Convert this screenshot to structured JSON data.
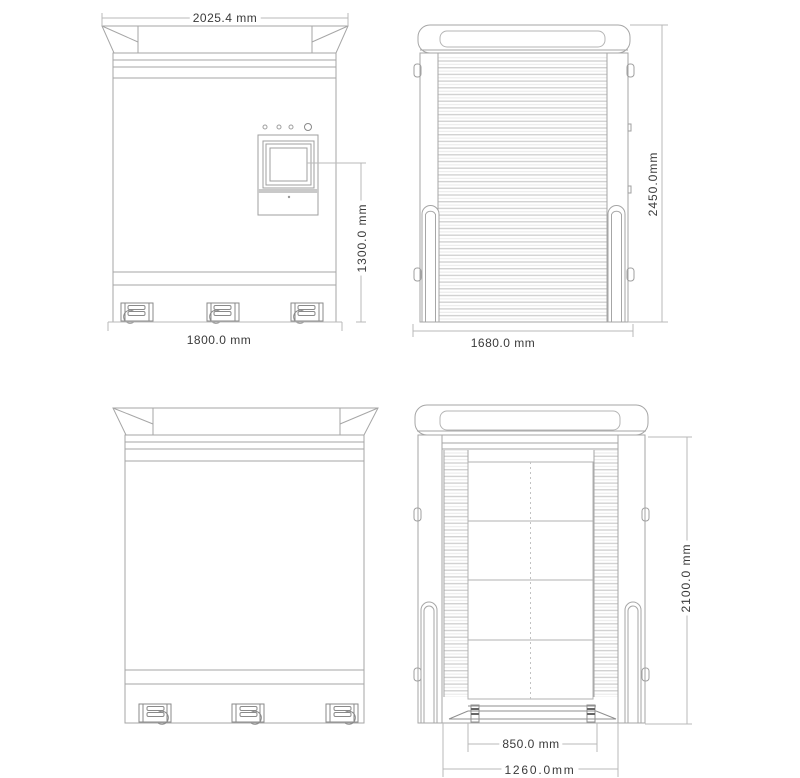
{
  "drawing": {
    "type": "four-view dimensional line drawing of an equipment cabinet",
    "colors": {
      "background": "#ffffff",
      "outline": "#a6a6a6",
      "dimension_lines": "#b9b9b9",
      "dimension_text": "#3a3a3a",
      "shutter_slat_dark": "#d2d2d2",
      "shutter_slat_light": "#e9e9e9"
    },
    "views": {
      "front": {
        "dim_top_width": "2025.4 mm",
        "dim_screen_height": "1300.0 mm",
        "dim_base_width": "1800.0 mm"
      },
      "side": {
        "dim_height": "2450.0mm",
        "dim_base_width": "1680.0 mm"
      },
      "rear": {},
      "open": {
        "dim_height": "2100.0 mm",
        "dim_inner_width": "850.0 mm",
        "dim_base_width": "1260.0mm"
      }
    }
  }
}
